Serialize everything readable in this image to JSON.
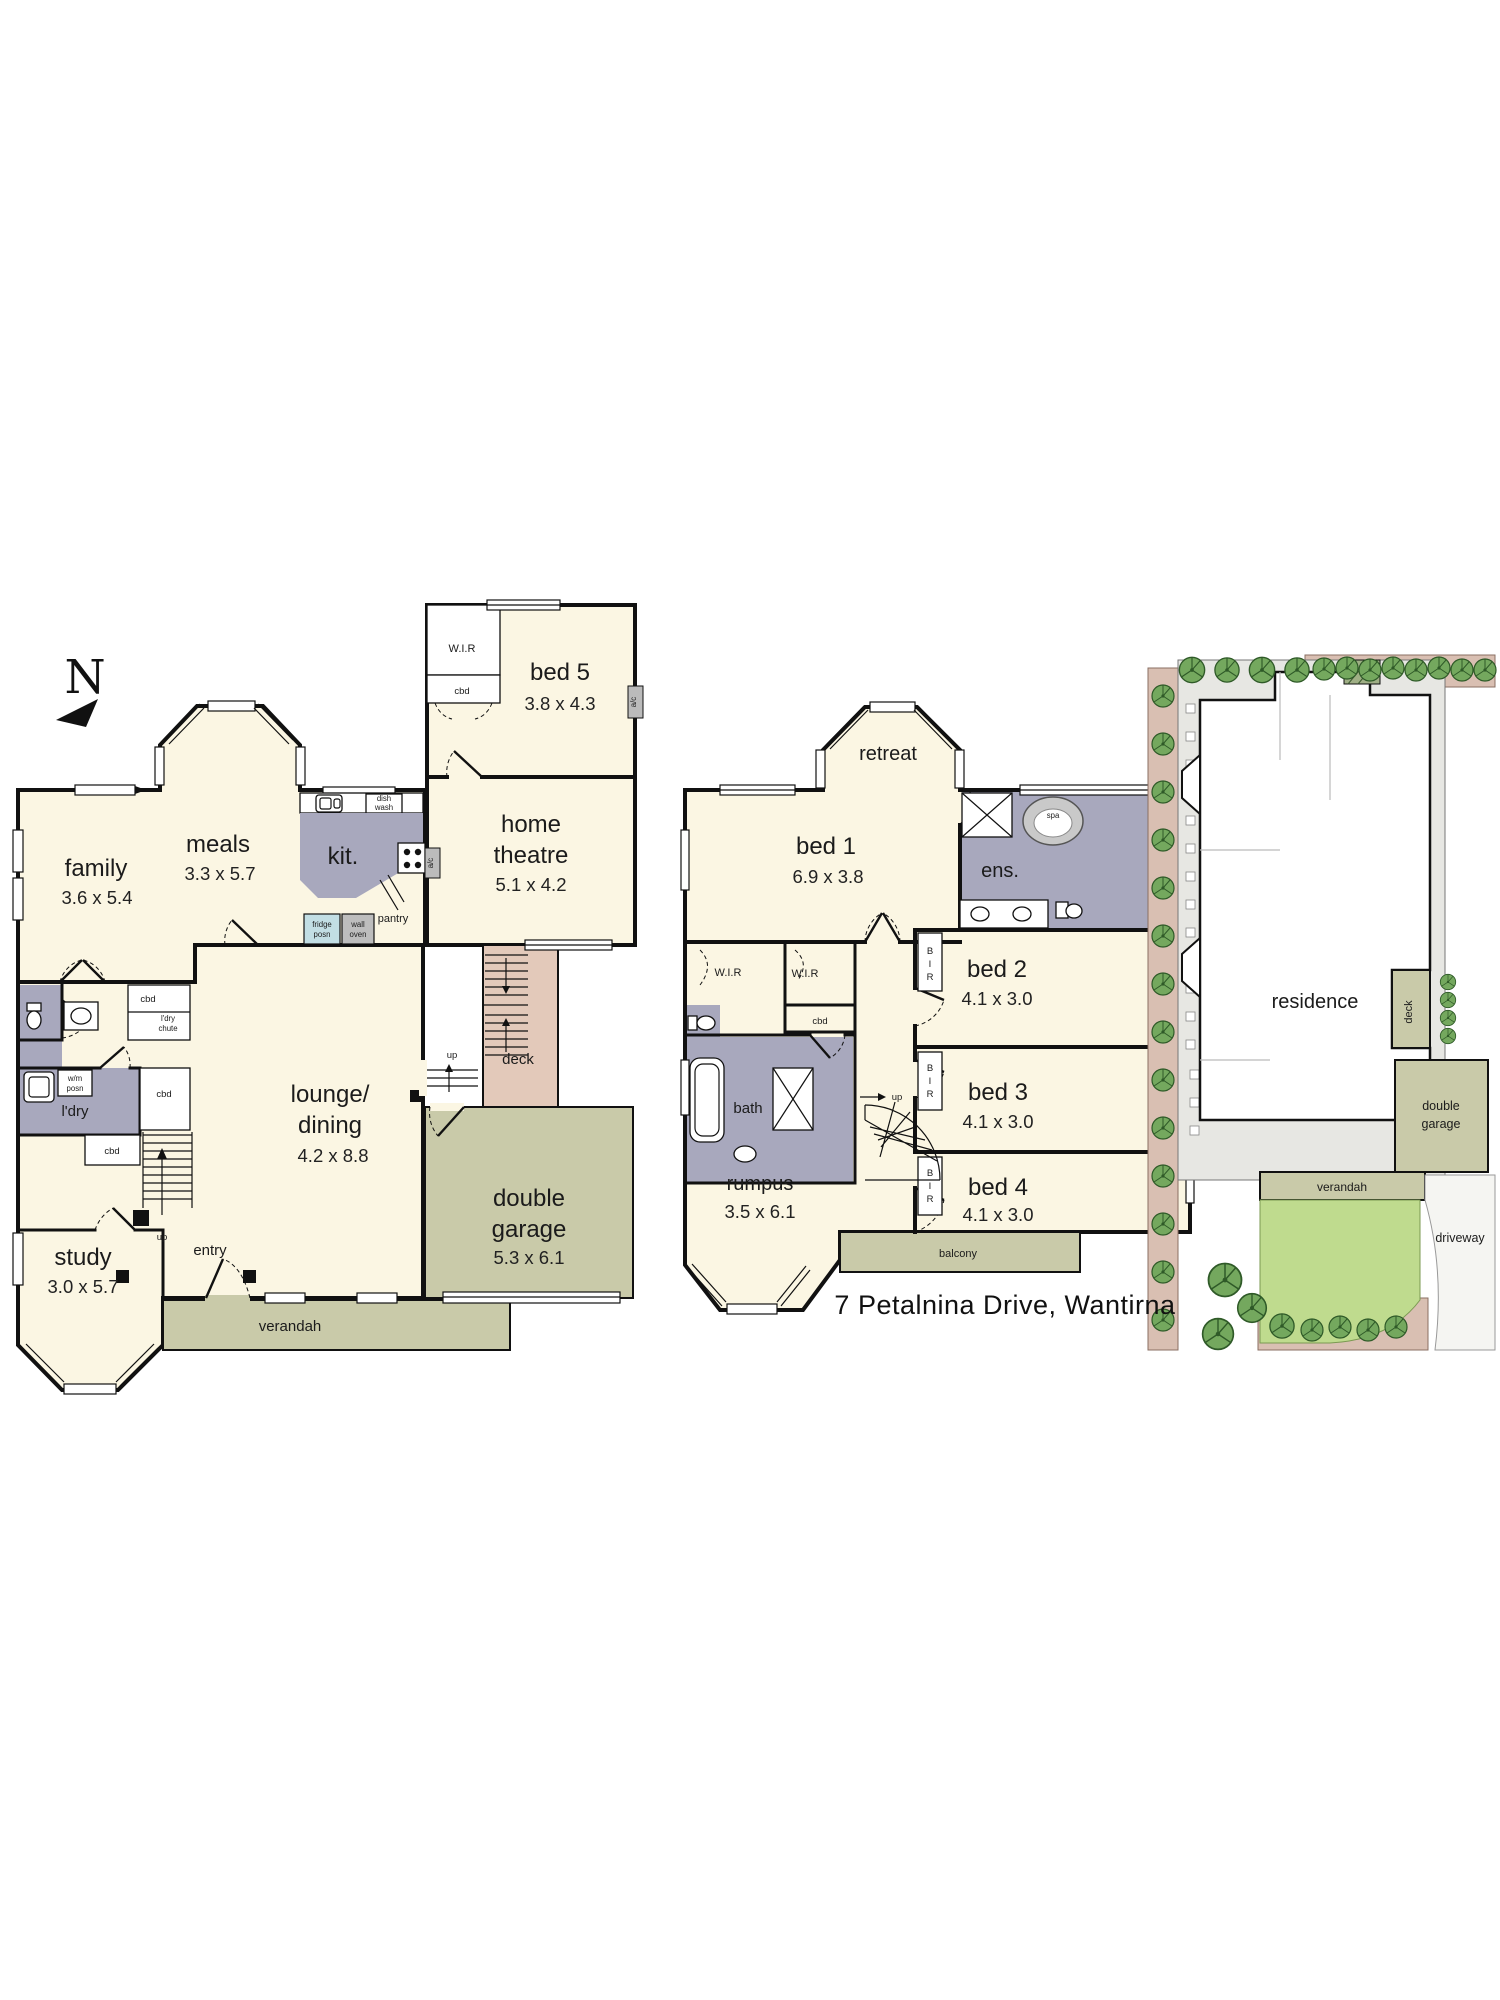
{
  "page": {
    "address": "7 Petalnina Drive, Wantirna"
  },
  "compass": {
    "north": "N"
  },
  "shared": {
    "wir": "W.I.R",
    "cbd": "cbd",
    "up": "up",
    "ac": "a/c",
    "bir": [
      "B",
      "I",
      "R"
    ]
  },
  "ground_floor": {
    "family": {
      "label": "family",
      "dims": "3.6 x 5.4"
    },
    "meals": {
      "label": "meals",
      "dims": "3.3 x 5.7"
    },
    "kitchen": {
      "label": "kit."
    },
    "bed5": {
      "label": "bed 5",
      "dims": "3.8 x 4.3"
    },
    "home_theatre": {
      "line1": "home",
      "line2": "theatre",
      "dims": "5.1 x 4.2"
    },
    "lounge_dining": {
      "line1": "lounge/",
      "line2": "dining",
      "dims": "4.2 x 8.8"
    },
    "study": {
      "label": "study",
      "dims": "3.0 x 5.7"
    },
    "laundry": {
      "label": "l'dry"
    },
    "garage": {
      "line1": "double",
      "line2": "garage",
      "dims": "5.3 x 6.1"
    },
    "deck": {
      "label": "deck"
    },
    "verandah": {
      "label": "verandah"
    },
    "entry": {
      "label": "entry"
    },
    "fixtures": {
      "dish_wash": [
        "dish",
        "wash"
      ],
      "fridge_posn": [
        "fridge",
        "posn"
      ],
      "wall_oven": [
        "wall",
        "oven"
      ],
      "pantry": "pantry",
      "ldry_chute": [
        "l'dry",
        "chute"
      ],
      "wm_posn": [
        "w/m",
        "posn"
      ]
    }
  },
  "first_floor": {
    "retreat": {
      "label": "retreat"
    },
    "bed1": {
      "label": "bed 1",
      "dims": "6.9 x 3.8"
    },
    "ensuite": {
      "label": "ens."
    },
    "spa": {
      "label": "spa"
    },
    "bed2": {
      "label": "bed 2",
      "dims": "4.1 x 3.0"
    },
    "bed3": {
      "label": "bed 3",
      "dims": "4.1 x 3.0"
    },
    "bed4": {
      "label": "bed 4",
      "dims": "4.1 x 3.0"
    },
    "bath": {
      "label": "bath"
    },
    "rumpus": {
      "label": "rumpus",
      "dims": "3.5 x 6.1"
    },
    "balcony": {
      "label": "balcony"
    }
  },
  "site_plan": {
    "residence": "residence",
    "deck": "deck",
    "garage_line1": "double",
    "garage_line2": "garage",
    "verandah": "verandah",
    "driveway": "driveway"
  },
  "colors": {
    "room_fill": "#FBF6E3",
    "wet_area": "#A8A8BD",
    "deck": "#E3C9BA",
    "outdoor": "#C9CAA9",
    "lawn": "#BFDB8E",
    "garden_bed": "#D9BFB2",
    "tree": "#74A85E"
  }
}
